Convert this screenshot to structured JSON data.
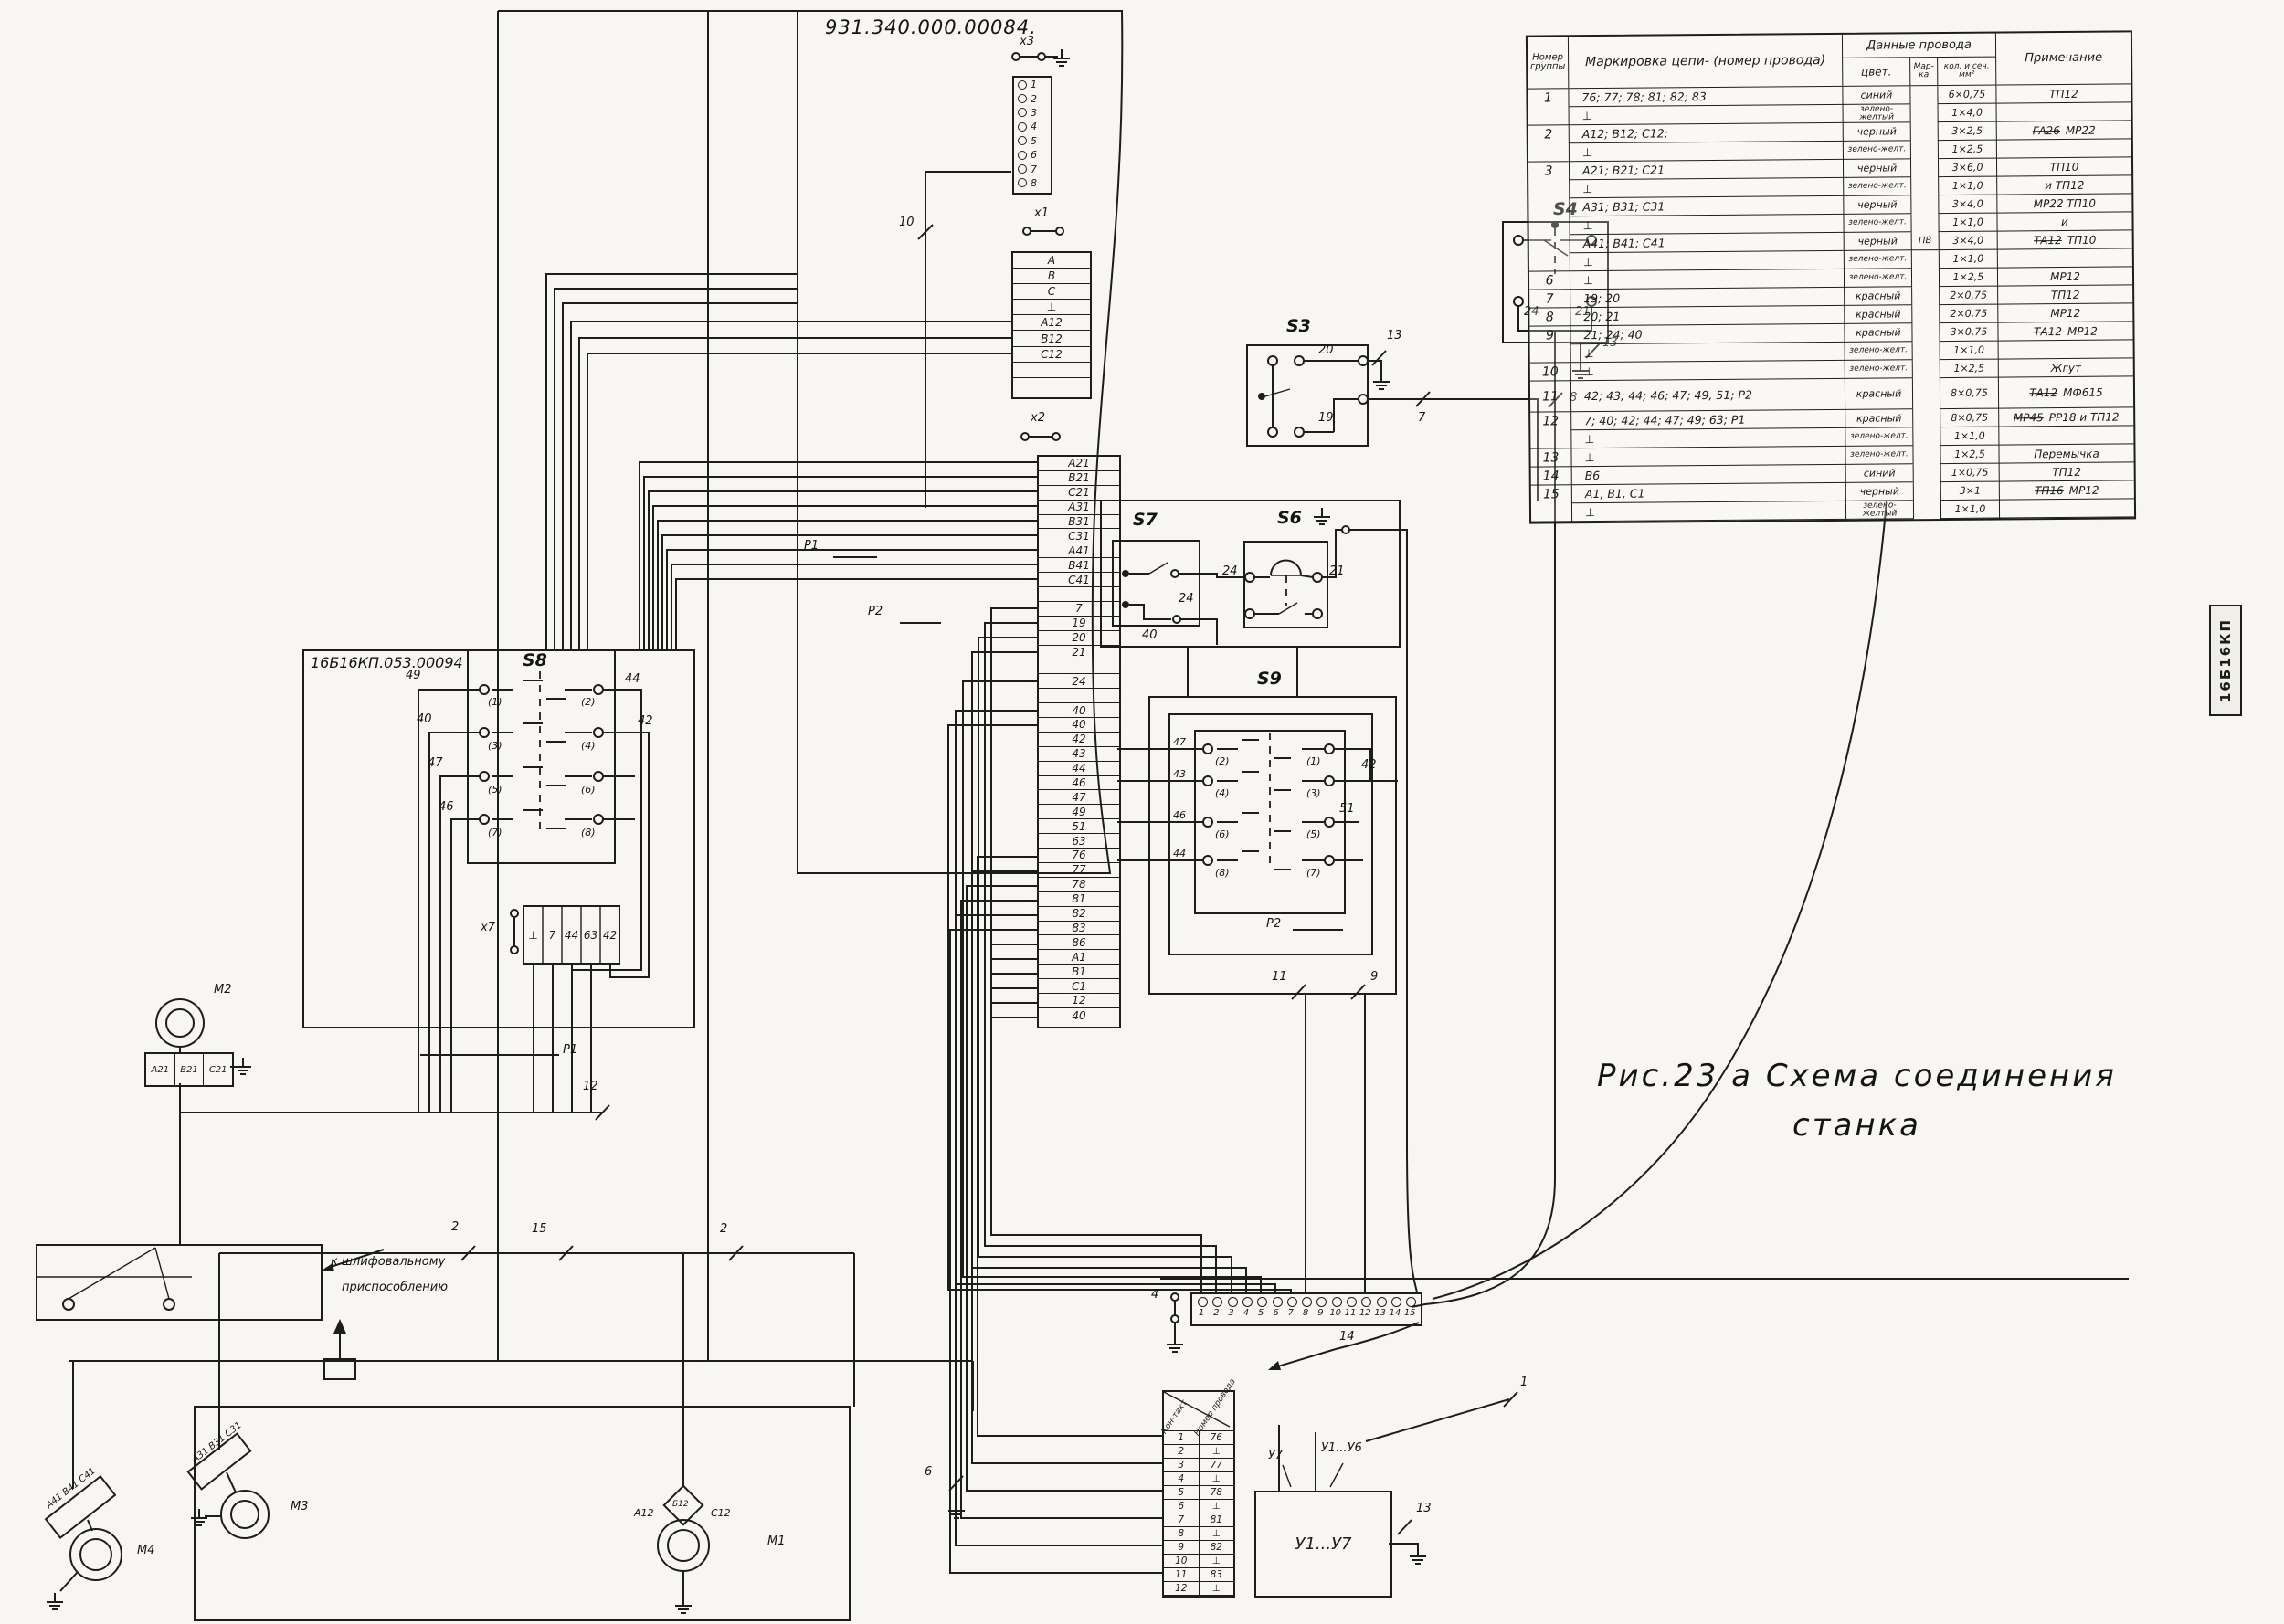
{
  "titles": {
    "main": "931.340.000.00084.",
    "left_panel": "16Б16КП.053.00094",
    "stamp": "16Б16КП"
  },
  "caption": {
    "line1": "Рис.23 а  Схема  соединения",
    "line2": "станка"
  },
  "notes": {
    "grind1": "к шлифовальному",
    "grind2": "приспособлению"
  },
  "wire_table": {
    "hdr": {
      "group": "Номер группы",
      "marking": "Маркировка цепи- (номер провода)",
      "data": "Данные провода",
      "color": "цвет.",
      "marka": "Мар- ка",
      "qty": "кол. и сеч. мм²",
      "note": "Примечание"
    },
    "rows": [
      {
        "g": "1",
        "m": "76; 77; 78; 81; 82; 83",
        "c": "синий",
        "mk": "",
        "q": "6×0,75",
        "ns": "",
        "n": "ТП12",
        "gend": false
      },
      {
        "g": "",
        "m": "⊥",
        "c": "зелено-желтый",
        "mk": "",
        "q": "1×4,0",
        "ns": "",
        "n": "",
        "gend": true
      },
      {
        "g": "2",
        "m": "А12; В12; С12;",
        "c": "черный",
        "mk": "",
        "q": "3×2,5",
        "ns": "ГА26",
        "n": "МР22",
        "gend": false
      },
      {
        "g": "",
        "m": "⊥",
        "c": "зелено-желт.",
        "mk": "",
        "q": "1×2,5",
        "ns": "",
        "n": "",
        "gend": true
      },
      {
        "g": "3",
        "m": "А21; В21; С21",
        "c": "черный",
        "mk": "",
        "q": "3×6,0",
        "ns": "",
        "n": "ТП10",
        "gend": false
      },
      {
        "g": "",
        "m": "⊥",
        "c": "зелено-желт.",
        "mk": "",
        "q": "1×1,0",
        "ns": "",
        "n": "и ТП12",
        "gend": false
      },
      {
        "g": "",
        "m": "А31; В31; С31",
        "c": "черный",
        "mk": "",
        "q": "3×4,0",
        "ns": "",
        "n": "МР22  ТП10",
        "gend": false
      },
      {
        "g": "",
        "m": "⊥",
        "c": "зелено-желт.",
        "mk": "",
        "q": "1×1,0",
        "ns": "",
        "n": "и",
        "gend": false
      },
      {
        "g": "",
        "m": "А41; В41; С41",
        "c": "черный",
        "mk": "ПВ",
        "q": "3×4,0",
        "ns": "ТА12",
        "n": "ТП10",
        "gend": false
      },
      {
        "g": "",
        "m": "⊥",
        "c": "зелено-желт.",
        "mk": "",
        "q": "1×1,0",
        "ns": "",
        "n": "",
        "gend": true
      },
      {
        "g": "6",
        "m": "⊥",
        "c": "зелено-желт.",
        "mk": "",
        "q": "1×2,5",
        "ns": "",
        "n": "МР12",
        "gend": true
      },
      {
        "g": "7",
        "m": "19; 20",
        "c": "красный",
        "mk": "",
        "q": "2×0,75",
        "ns": "",
        "n": "ТП12",
        "gend": true
      },
      {
        "g": "8",
        "m": "20; 21",
        "c": "красный",
        "mk": "",
        "q": "2×0,75",
        "ns": "",
        "n": "МР12",
        "gend": true
      },
      {
        "g": "9",
        "m": "21; 24; 40",
        "c": "красный",
        "mk": "",
        "q": "3×0,75",
        "ns": "ТА12",
        "n": "МР12",
        "gend": false
      },
      {
        "g": "",
        "m": "⊥",
        "c": "зелено-желт.",
        "mk": "",
        "q": "1×1,0",
        "ns": "",
        "n": "",
        "gend": true
      },
      {
        "g": "10",
        "m": "⊥",
        "c": "зелено-желт.",
        "mk": "",
        "q": "1×2,5",
        "ns": "",
        "n": "Жгут",
        "gend": true
      },
      {
        "g": "11",
        "m": "42; 43; 44; 46; 47; 49, 51; Р2",
        "c": "красный",
        "mk": "",
        "q": "8×0,75",
        "ns": "ТА12",
        "n": "МФ615",
        "gend": true,
        "h": 34
      },
      {
        "g": "12",
        "m": "7; 40; 42; 44; 47; 49; 63; Р1",
        "c": "красный",
        "mk": "",
        "q": "8×0,75",
        "ns": "МР45",
        "n": "РР18 и ТП12",
        "gend": false
      },
      {
        "g": "",
        "m": "⊥",
        "c": "зелено-желт.",
        "mk": "",
        "q": "1×1,0",
        "ns": "",
        "n": "",
        "gend": true
      },
      {
        "g": "13",
        "m": "⊥",
        "c": "зелено-желт.",
        "mk": "",
        "q": "1×2,5",
        "ns": "",
        "n": "Перемычка",
        "gend": true
      },
      {
        "g": "14",
        "m": "В6",
        "c": "синий",
        "mk": "",
        "q": "1×0,75",
        "ns": "",
        "n": "ТП12",
        "gend": true
      },
      {
        "g": "15",
        "m": "А1, В1, С1",
        "c": "черный",
        "mk": "",
        "q": "3×1",
        "ns": "ТП16",
        "n": "МР12",
        "gend": false
      },
      {
        "g": "",
        "m": "⊥",
        "c": "зелено-желтый",
        "mk": "",
        "q": "1×1,0",
        "ns": "",
        "n": "",
        "gend": true
      }
    ]
  },
  "conn": {
    "x3": {
      "label": "х3",
      "pins": [
        "1",
        "2",
        "3",
        "4",
        "5",
        "6",
        "7",
        "8"
      ]
    },
    "x1": {
      "label": "х1",
      "pins": [
        "А",
        "В",
        "С",
        "⊥",
        "А12",
        "В12",
        "С12",
        "",
        ""
      ]
    },
    "x2": {
      "label": "х2",
      "pins": [
        "А21",
        "В21",
        "С21",
        "А31",
        "В31",
        "С31",
        "А41",
        "В41",
        "С41",
        "",
        "7",
        "19",
        "20",
        "21",
        "",
        "24",
        "",
        "40",
        "40",
        "42",
        "43",
        "44",
        "46",
        "47",
        "49",
        "51",
        "63",
        "76",
        "77",
        "78",
        "81",
        "82",
        "83",
        "86",
        "А1",
        "В1",
        "С1",
        "12",
        "40"
      ]
    },
    "x7": {
      "label": "х7",
      "p1": "Р1",
      "cells": [
        "⊥",
        "7",
        "44",
        "63",
        "42"
      ]
    },
    "strip": {
      "pins": [
        "1",
        "2",
        "3",
        "4",
        "5",
        "6",
        "7",
        "8",
        "9",
        "10",
        "11",
        "12",
        "13",
        "14",
        "15"
      ]
    },
    "ctable": {
      "h1": "Кон-такт",
      "h2": "Номер провода",
      "rows": [
        {
          "c": "1",
          "w": "76"
        },
        {
          "c": "2",
          "w": "⊥"
        },
        {
          "c": "3",
          "w": "77"
        },
        {
          "c": "4",
          "w": "⊥"
        },
        {
          "c": "5",
          "w": "78"
        },
        {
          "c": "6",
          "w": "⊥"
        },
        {
          "c": "7",
          "w": "81"
        },
        {
          "c": "8",
          "w": "⊥"
        },
        {
          "c": "9",
          "w": "82"
        },
        {
          "c": "10",
          "w": "⊥"
        },
        {
          "c": "11",
          "w": "83"
        },
        {
          "c": "12",
          "w": "⊥"
        }
      ]
    }
  },
  "sw": {
    "s3": {
      "label": "S3",
      "t": "20",
      "b": "19"
    },
    "s4": {
      "label": "S4",
      "l": "24",
      "r": "21"
    },
    "s6": {
      "label": "S6",
      "l": "24",
      "r": "21"
    },
    "s7": {
      "label": "S7",
      "a": "24",
      "b": "40"
    },
    "s8": {
      "label": "S8",
      "contacts": [
        "(1)",
        "(2)",
        "(3)",
        "(4)",
        "(5)",
        "(6)",
        "(7)",
        "(8)"
      ],
      "lw": [
        "49",
        "40",
        "47",
        "46"
      ],
      "rw": [
        "44",
        "42"
      ]
    },
    "s9": {
      "label": "S9",
      "contacts": [
        "(2)",
        "(1)",
        "(4)",
        "(3)",
        "(6)",
        "(5)",
        "(8)",
        "(7)"
      ],
      "lw": [
        "47",
        "43",
        "46",
        "44"
      ],
      "rw": [
        "42",
        "51"
      ],
      "p2": "Р2"
    }
  },
  "relays": {
    "p1": "Р1",
    "p2": "Р2"
  },
  "motors": {
    "m1": {
      "label": "М1",
      "w1": "А12",
      "w2": "Б12",
      "w3": "С12"
    },
    "m2": {
      "label": "М2",
      "w": [
        "А21",
        "В21",
        "С21"
      ]
    },
    "m3": {
      "label": "М3",
      "w": "А31 В31 С31"
    },
    "m4": {
      "label": "М4",
      "w": "А41 В41 С41"
    }
  },
  "ybox": {
    "inner": "У1...У7",
    "tl": "У7",
    "tr": "У1...У6"
  },
  "wires": {
    "n1": "1",
    "n2": "2",
    "n2b": "2",
    "n4": "4",
    "n6": "6",
    "n7": "7",
    "n8": "8",
    "n9": "9",
    "n10": "10",
    "n11": "11",
    "n12": "12",
    "n13a": "13",
    "n13b": "13",
    "n13c": "13",
    "n14": "14",
    "n15": "15"
  }
}
